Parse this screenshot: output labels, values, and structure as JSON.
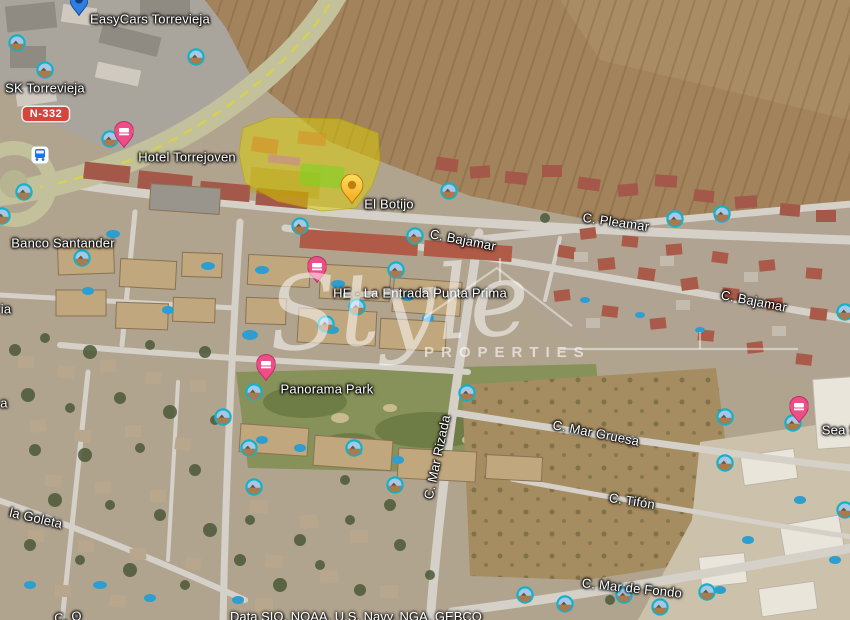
{
  "map": {
    "view_type": "satellite-aerial",
    "attribution": "Data SIO, NOAA, U.S. Navy, NGA, GEBCO",
    "watermark": {
      "script": "Style",
      "caps": "PROPERTIES"
    },
    "road_badge": {
      "text": "N-332",
      "x": 46,
      "y": 114,
      "bg_color": "#d7443c"
    },
    "place_labels": [
      {
        "text": "EasyCars Torrevieja",
        "x": 150,
        "y": 19
      },
      {
        "text": "SK Torrevieja",
        "x": 45,
        "y": 88
      },
      {
        "text": "Hotel Torrejoven",
        "x": 187,
        "y": 157
      },
      {
        "text": "El Botijo",
        "x": 389,
        "y": 204
      },
      {
        "text": "Banco Santander",
        "x": 63,
        "y": 243
      },
      {
        "text": "HE - La Entrada Punta Prima",
        "x": 420,
        "y": 293
      },
      {
        "text": "Panorama Park",
        "x": 327,
        "y": 389
      },
      {
        "text": "Sea S",
        "x": 840,
        "y": 430
      },
      {
        "text": "ia",
        "x": 6,
        "y": 309
      },
      {
        "text": "a",
        "x": 4,
        "y": 403
      }
    ],
    "street_labels": [
      {
        "text": "C. Pleamar",
        "x": 616,
        "y": 222,
        "rot": 8
      },
      {
        "text": "C. Bajamar",
        "x": 463,
        "y": 240,
        "rot": 11
      },
      {
        "text": "C. Bajamar",
        "x": 754,
        "y": 301,
        "rot": 11
      },
      {
        "text": "C. Mar Rizada",
        "x": 437,
        "y": 457,
        "rot": -78
      },
      {
        "text": "C. Mar Gruesa",
        "x": 596,
        "y": 433,
        "rot": 11
      },
      {
        "text": "C. Tifón",
        "x": 632,
        "y": 501,
        "rot": 9
      },
      {
        "text": "C. Mar de Fondo",
        "x": 632,
        "y": 588,
        "rot": 6
      },
      {
        "text": "la Goleta",
        "x": 36,
        "y": 518,
        "rot": 13
      },
      {
        "text": "C. O",
        "x": 68,
        "y": 617,
        "rot": -6
      }
    ],
    "lodging_pins": [
      {
        "x": 124,
        "y": 148
      },
      {
        "x": 317,
        "y": 283
      },
      {
        "x": 266,
        "y": 381
      },
      {
        "x": 799,
        "y": 423
      }
    ],
    "blue_place_pin": {
      "x": 79,
      "y": 16
    },
    "transit_icons": [
      {
        "x": 40,
        "y": 155
      }
    ],
    "photo_icons": [
      {
        "x": 196,
        "y": 57
      },
      {
        "x": 45,
        "y": 70
      },
      {
        "x": 17,
        "y": 43
      },
      {
        "x": 110,
        "y": 139
      },
      {
        "x": 24,
        "y": 192
      },
      {
        "x": 2,
        "y": 216
      },
      {
        "x": 82,
        "y": 258
      },
      {
        "x": 300,
        "y": 226
      },
      {
        "x": 449,
        "y": 191
      },
      {
        "x": 415,
        "y": 236
      },
      {
        "x": 675,
        "y": 219
      },
      {
        "x": 722,
        "y": 214
      },
      {
        "x": 845,
        "y": 312
      },
      {
        "x": 396,
        "y": 270
      },
      {
        "x": 357,
        "y": 307
      },
      {
        "x": 326,
        "y": 324
      },
      {
        "x": 254,
        "y": 392
      },
      {
        "x": 223,
        "y": 417
      },
      {
        "x": 249,
        "y": 448
      },
      {
        "x": 254,
        "y": 487
      },
      {
        "x": 354,
        "y": 448
      },
      {
        "x": 395,
        "y": 485
      },
      {
        "x": 467,
        "y": 393
      },
      {
        "x": 725,
        "y": 417
      },
      {
        "x": 725,
        "y": 463
      },
      {
        "x": 845,
        "y": 510
      },
      {
        "x": 525,
        "y": 595
      },
      {
        "x": 565,
        "y": 604
      },
      {
        "x": 624,
        "y": 595
      },
      {
        "x": 707,
        "y": 592
      },
      {
        "x": 660,
        "y": 607
      },
      {
        "x": 793,
        "y": 423
      }
    ],
    "property_highlight": {
      "fill_color": "#ded000",
      "pin_color": "#f2a71c",
      "pin": {
        "x": 352,
        "y": 204
      },
      "polygon": [
        [
          243,
          128
        ],
        [
          272,
          117
        ],
        [
          340,
          119
        ],
        [
          378,
          133
        ],
        [
          380,
          162
        ],
        [
          372,
          186
        ],
        [
          356,
          208
        ],
        [
          322,
          211
        ],
        [
          277,
          201
        ],
        [
          245,
          183
        ],
        [
          239,
          153
        ]
      ]
    }
  }
}
